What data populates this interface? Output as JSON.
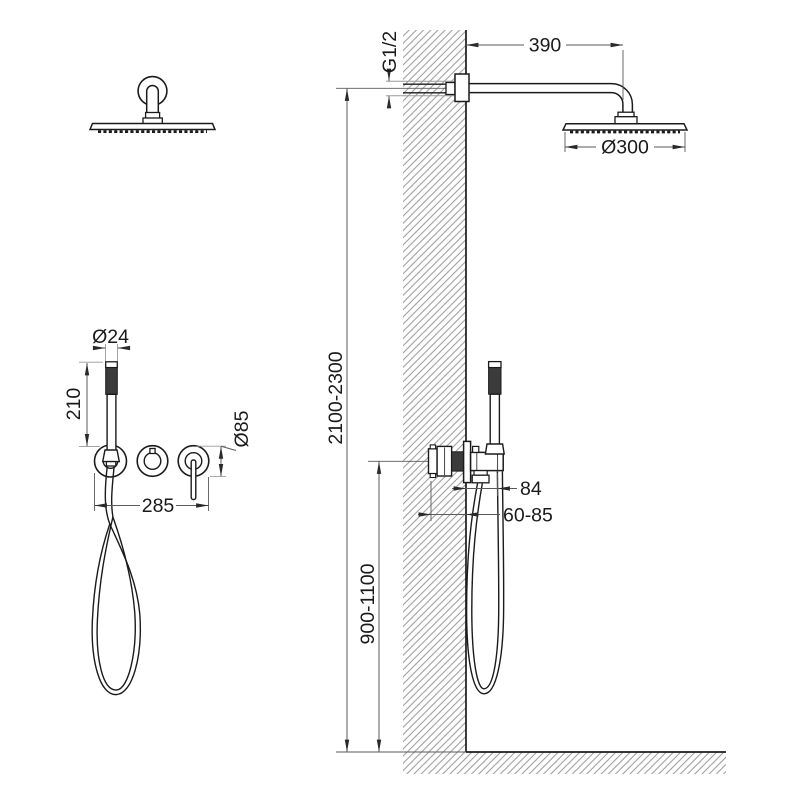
{
  "drawing": {
    "dimensions": {
      "arm_length": "390",
      "inlet_thread": "G1/2",
      "head_diameter": "Ø300",
      "install_height_range": "2100-2300",
      "valve_height_range": "900-1100",
      "trim_projection": "84",
      "rough_in_depth_range": "60-85",
      "handshower_diameter": "Ø24",
      "handshower_length": "210",
      "valve_trim_width": "285",
      "escutcheon_diameter": "Ø85"
    },
    "colors": {
      "line": "#1b1b1b",
      "dim_line": "#5a5a5a",
      "ext_line_light": "#9a9a9a",
      "hatch": "#989898",
      "dark_fill": "#3b3b3b",
      "background": "#ffffff"
    }
  }
}
